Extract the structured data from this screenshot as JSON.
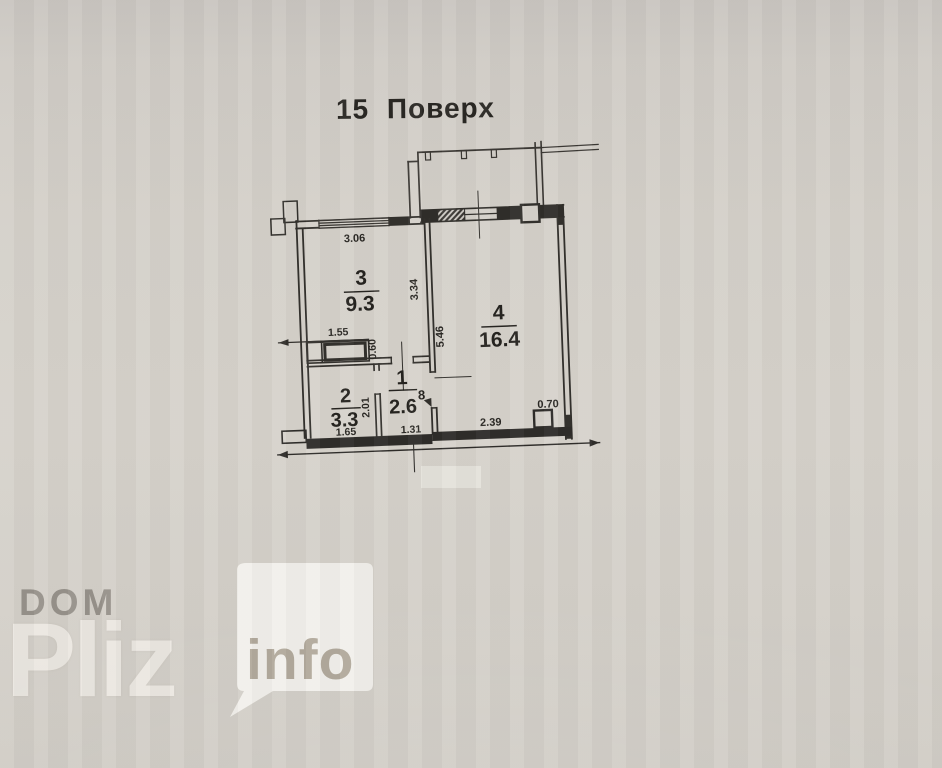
{
  "title": "15 Поверх",
  "plan": {
    "rooms": [
      {
        "number": "3",
        "area": "9.3"
      },
      {
        "number": "4",
        "area": "16.4"
      },
      {
        "number": "2",
        "area": "3.3"
      },
      {
        "number": "1",
        "area": "2.6"
      }
    ],
    "dims": {
      "window_top": "3.06",
      "room3_depth": "3.34",
      "room4_depth": "5.46",
      "closet_width": "1.55",
      "opening": "0.60",
      "room2_depth": "2.01",
      "room2_width": "1.65",
      "hall_width": "1.31",
      "room4_bottom": "2.39",
      "column": "0.70",
      "hall_mark": "8"
    }
  },
  "watermark": {
    "top": "DOM",
    "main": "Pliz",
    "badge": "info"
  },
  "colors": {
    "paper": "#d4d0c9",
    "ink": "#33312d",
    "watermark_gray": "#8d8881",
    "badge_bg": "#f3f1ec",
    "badge_text": "#b2aa9d"
  }
}
